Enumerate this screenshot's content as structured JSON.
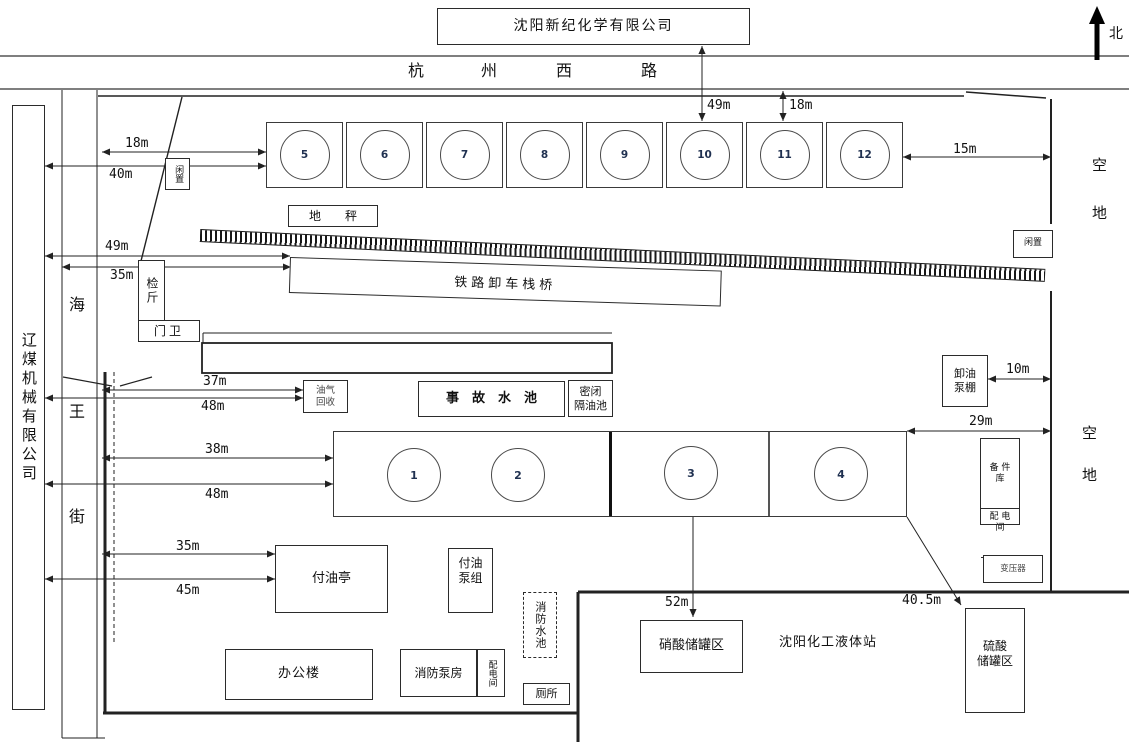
{
  "compass": {
    "north_label": "北"
  },
  "header": {
    "company_title": "沈阳新纪化学有限公司",
    "road_chars": [
      "杭",
      "州",
      "西",
      "路"
    ]
  },
  "neighbors": {
    "west_company_vertical": "辽煤机械有限公司",
    "street_chars": [
      "海",
      "王",
      "街"
    ],
    "vacant_upper": [
      "空",
      "地"
    ],
    "vacant_lower": [
      "空",
      "地"
    ],
    "south_station": "沈阳化工液体站"
  },
  "tank_row": {
    "numbers": [
      "5",
      "6",
      "7",
      "8",
      "9",
      "10",
      "11",
      "12"
    ]
  },
  "tank_area": {
    "numbers": [
      "1",
      "2",
      "3",
      "4"
    ]
  },
  "buildings": {
    "idle_box_left": "闲置",
    "idle_box_right": "闲置",
    "weighbridge": "地　　秤",
    "railway_trestle": "铁路卸车栈桥",
    "weigh_office": "检斤",
    "gate_house": "门卫",
    "vapor_recovery": "油气\n回收",
    "accident_pool": "事　故　水　池",
    "sealed_oil_separator": "密闭\n隔油池",
    "unloading_pump_shed": "卸油\n泵棚",
    "spare_parts_store": "备 件\n库",
    "power_room_east": "配 电\n间",
    "generator_room": "发电\n机房",
    "transformer": "变压器",
    "oil_dispensing_kiosk": "付油亭",
    "oil_pump_group": "付油\n泵组",
    "fire_water_pool": "消防水池",
    "office_building": "办公楼",
    "fire_pump_house": "消防泵房",
    "power_room_south": "配电间",
    "toilet": "厕所",
    "nitric_acid_tank_area": "硝酸储罐区",
    "sulfuric_acid_tank_area": "硫酸\n储罐区"
  },
  "measurements": {
    "west_18m": "18m",
    "west_40m": "40m",
    "west_49m": "49m",
    "west_35m": "35m",
    "west_37m": "37m",
    "west_48m": "48m",
    "west_38m": "38m",
    "west_48m_b": "48m",
    "west_35m_b": "35m",
    "west_45m": "45m",
    "north_49m": "49m",
    "north_18m": "18m",
    "east_15m": "15m",
    "east_10m": "10m",
    "east_29m": "29m",
    "south_52m": "52m",
    "south_40_5m": "40.5m"
  }
}
